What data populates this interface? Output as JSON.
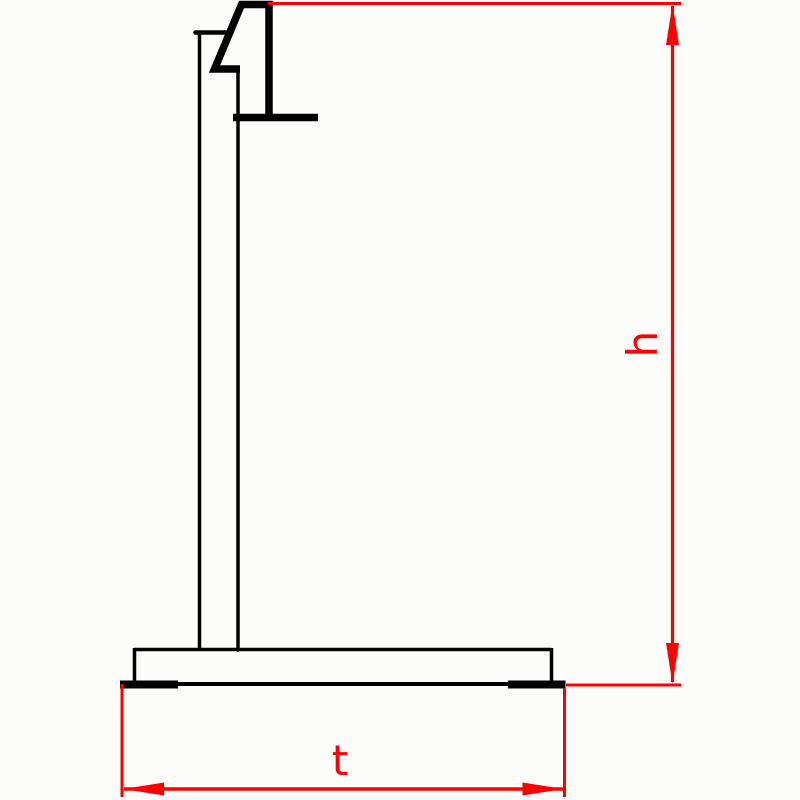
{
  "drawing": {
    "type": "technical-side-view",
    "dimensions": {
      "height": {
        "label": "h",
        "orientation": "vertical"
      },
      "depth": {
        "label": "t",
        "orientation": "horizontal"
      }
    }
  },
  "colors": {
    "dimension_red": "#fe0000",
    "outline_black": "#000000",
    "background": "#fcfcfa"
  }
}
